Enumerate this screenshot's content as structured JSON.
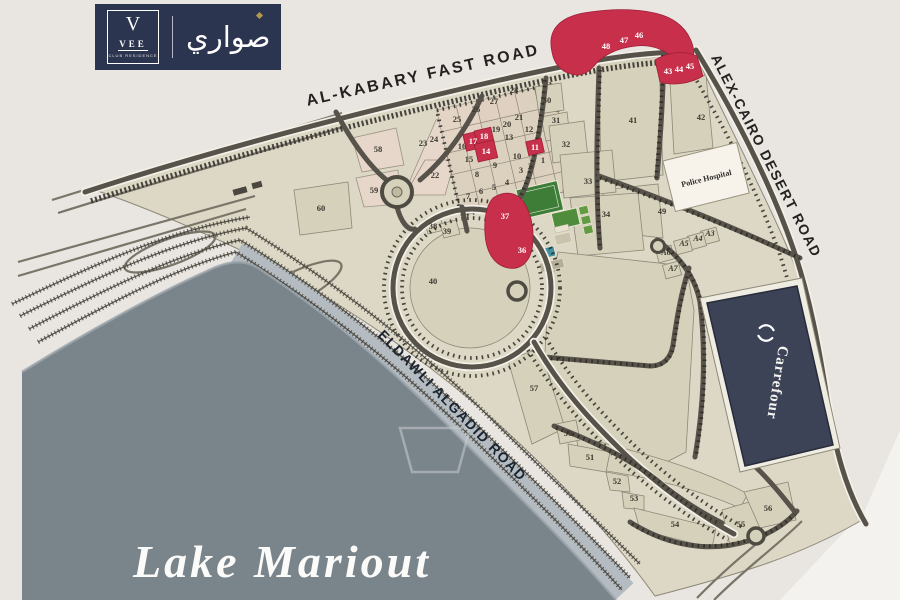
{
  "logo": {
    "v_mark": "V",
    "name": "VEE",
    "subtitle": "CLUB RESIDENCE",
    "arabic_name": "صواري"
  },
  "map": {
    "roads": {
      "top_label": "AL-KABARY FAST ROAD",
      "right_label": "ALEX-CAIRO DESERT ROAD",
      "shore_label": "ELDAWLI ALGADID ROAD"
    },
    "lake": {
      "label": "Lake Mariout"
    },
    "landmarks": {
      "police_hospital": "Police Hospital",
      "carrefour": "Carrefour"
    },
    "colors": {
      "brand_navy": "#2c3550",
      "plot_red": "#c72f4a",
      "plot_beige": "#d6d1bb",
      "lake_gray": "#7a848b"
    },
    "plots": [
      {
        "label": "1",
        "x": 543,
        "y": 163,
        "red": false
      },
      {
        "label": "2",
        "x": 530,
        "y": 169,
        "red": false
      },
      {
        "label": "3",
        "x": 521,
        "y": 173,
        "red": false
      },
      {
        "label": "4",
        "x": 507,
        "y": 185,
        "red": false
      },
      {
        "label": "5",
        "x": 494,
        "y": 190,
        "red": false
      },
      {
        "label": "6",
        "x": 481,
        "y": 194,
        "red": false
      },
      {
        "label": "7",
        "x": 468,
        "y": 199,
        "red": false
      },
      {
        "label": "8",
        "x": 477,
        "y": 177,
        "red": false
      },
      {
        "label": "9",
        "x": 495,
        "y": 168,
        "red": false
      },
      {
        "label": "10",
        "x": 517,
        "y": 159,
        "red": false
      },
      {
        "label": "11",
        "x": 535,
        "y": 150,
        "red": true
      },
      {
        "label": "12",
        "x": 529,
        "y": 132,
        "red": false
      },
      {
        "label": "13",
        "x": 509,
        "y": 140,
        "red": false
      },
      {
        "label": "14",
        "x": 486,
        "y": 154,
        "red": true
      },
      {
        "label": "15",
        "x": 469,
        "y": 162,
        "red": false
      },
      {
        "label": "16",
        "x": 462,
        "y": 149,
        "red": false
      },
      {
        "label": "17",
        "x": 473,
        "y": 144,
        "red": true
      },
      {
        "label": "18",
        "x": 484,
        "y": 139,
        "red": true
      },
      {
        "label": "19",
        "x": 496,
        "y": 132,
        "red": false
      },
      {
        "label": "20",
        "x": 507,
        "y": 127,
        "red": false
      },
      {
        "label": "21",
        "x": 519,
        "y": 120,
        "red": false
      },
      {
        "label": "22",
        "x": 435,
        "y": 178,
        "red": false
      },
      {
        "label": "23",
        "x": 423,
        "y": 146,
        "red": false
      },
      {
        "label": "24",
        "x": 434,
        "y": 142,
        "red": false
      },
      {
        "label": "25",
        "x": 457,
        "y": 122,
        "red": false
      },
      {
        "label": "26",
        "x": 476,
        "y": 112,
        "red": false
      },
      {
        "label": "27",
        "x": 494,
        "y": 104,
        "red": false
      },
      {
        "label": "28",
        "x": 514,
        "y": 93,
        "red": false
      },
      {
        "label": "30",
        "x": 547,
        "y": 103,
        "red": false
      },
      {
        "label": "31",
        "x": 556,
        "y": 123,
        "red": false
      },
      {
        "label": "32",
        "x": 566,
        "y": 147,
        "red": false
      },
      {
        "label": "33",
        "x": 588,
        "y": 184,
        "red": false
      },
      {
        "label": "34",
        "x": 606,
        "y": 217,
        "red": false
      },
      {
        "label": "36",
        "x": 522,
        "y": 253,
        "red": true
      },
      {
        "label": "37",
        "x": 505,
        "y": 219,
        "red": true
      },
      {
        "label": "38",
        "x": 433,
        "y": 229,
        "red": false
      },
      {
        "label": "39",
        "x": 447,
        "y": 234,
        "red": false
      },
      {
        "label": "40",
        "x": 433,
        "y": 284,
        "red": false
      },
      {
        "label": "41",
        "x": 633,
        "y": 123,
        "red": false
      },
      {
        "label": "42",
        "x": 701,
        "y": 120,
        "red": false
      },
      {
        "label": "43",
        "x": 668,
        "y": 74,
        "red": true
      },
      {
        "label": "44",
        "x": 679,
        "y": 72,
        "red": true
      },
      {
        "label": "45",
        "x": 690,
        "y": 69,
        "red": true
      },
      {
        "label": "46",
        "x": 639,
        "y": 38,
        "red": true
      },
      {
        "label": "47",
        "x": 624,
        "y": 43,
        "red": true
      },
      {
        "label": "48",
        "x": 606,
        "y": 49,
        "red": true
      },
      {
        "label": "49",
        "x": 662,
        "y": 214,
        "red": false
      },
      {
        "label": "50",
        "x": 568,
        "y": 436,
        "red": false
      },
      {
        "label": "51",
        "x": 590,
        "y": 460,
        "red": false
      },
      {
        "label": "52",
        "x": 617,
        "y": 484,
        "red": false
      },
      {
        "label": "53",
        "x": 634,
        "y": 501,
        "red": false
      },
      {
        "label": "54",
        "x": 675,
        "y": 527,
        "red": false
      },
      {
        "label": "55",
        "x": 741,
        "y": 527,
        "red": false
      },
      {
        "label": "56",
        "x": 768,
        "y": 511,
        "red": false
      },
      {
        "label": "57",
        "x": 534,
        "y": 391,
        "red": false
      },
      {
        "label": "58",
        "x": 378,
        "y": 152,
        "red": false
      },
      {
        "label": "59",
        "x": 374,
        "y": 193,
        "red": false
      },
      {
        "label": "60",
        "x": 321,
        "y": 211,
        "red": false
      },
      {
        "label": "A3",
        "x": 710,
        "y": 236,
        "red": false
      },
      {
        "label": "A4",
        "x": 698,
        "y": 241,
        "red": false
      },
      {
        "label": "A5",
        "x": 684,
        "y": 246,
        "red": false
      },
      {
        "label": "A6",
        "x": 666,
        "y": 255,
        "red": false
      },
      {
        "label": "A7",
        "x": 673,
        "y": 271,
        "red": false
      }
    ]
  }
}
